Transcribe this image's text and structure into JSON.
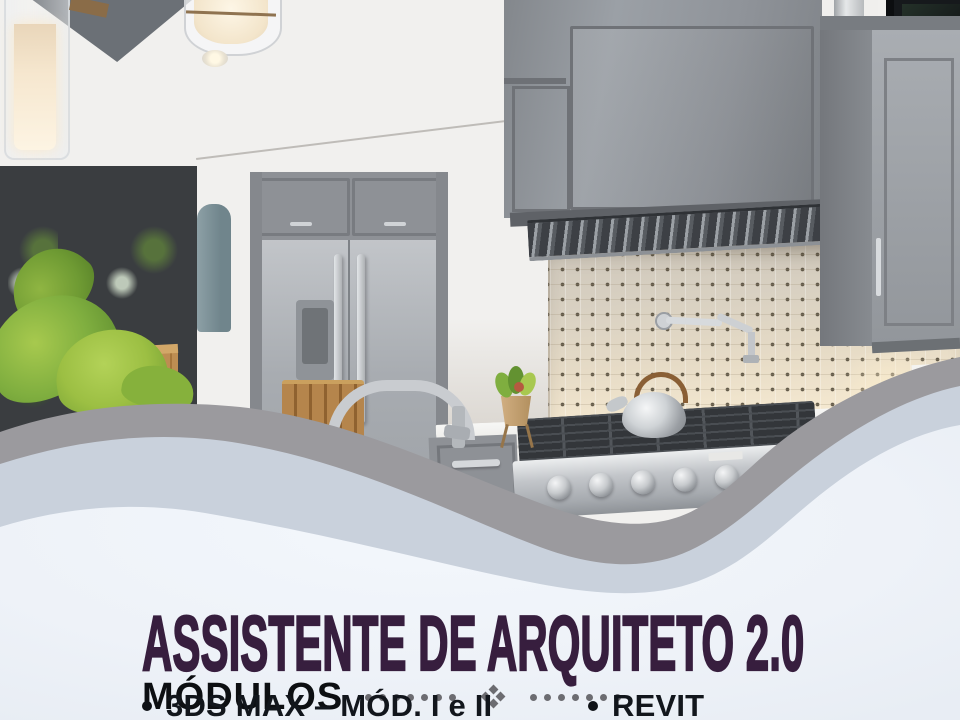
{
  "poster": {
    "title": "ASSISTENTE DE ARQUITETO 2.0",
    "modules_heading": "MÓDULOS",
    "modules": [
      {
        "label": "3DS MAX – MÓD. I e II"
      },
      {
        "label": "REVIT"
      }
    ],
    "separator": {
      "dots_per_side": 7,
      "icon": "four-diamond-cluster"
    },
    "colors": {
      "title_purple": "#371e3e",
      "heading_black": "#0d0f12",
      "bullet_text": "#12161c",
      "dot_gray": "#6c6c71",
      "wave_gray": "#9b9a9e",
      "wave_blue": "#c9d1dc",
      "panel_bg": "#eef2f8"
    }
  },
  "hero": {
    "description": "Modern kitchen with gray shaker cabinets, stainless refrigerator and range, marble pin-dot backsplash, window with greenery"
  }
}
